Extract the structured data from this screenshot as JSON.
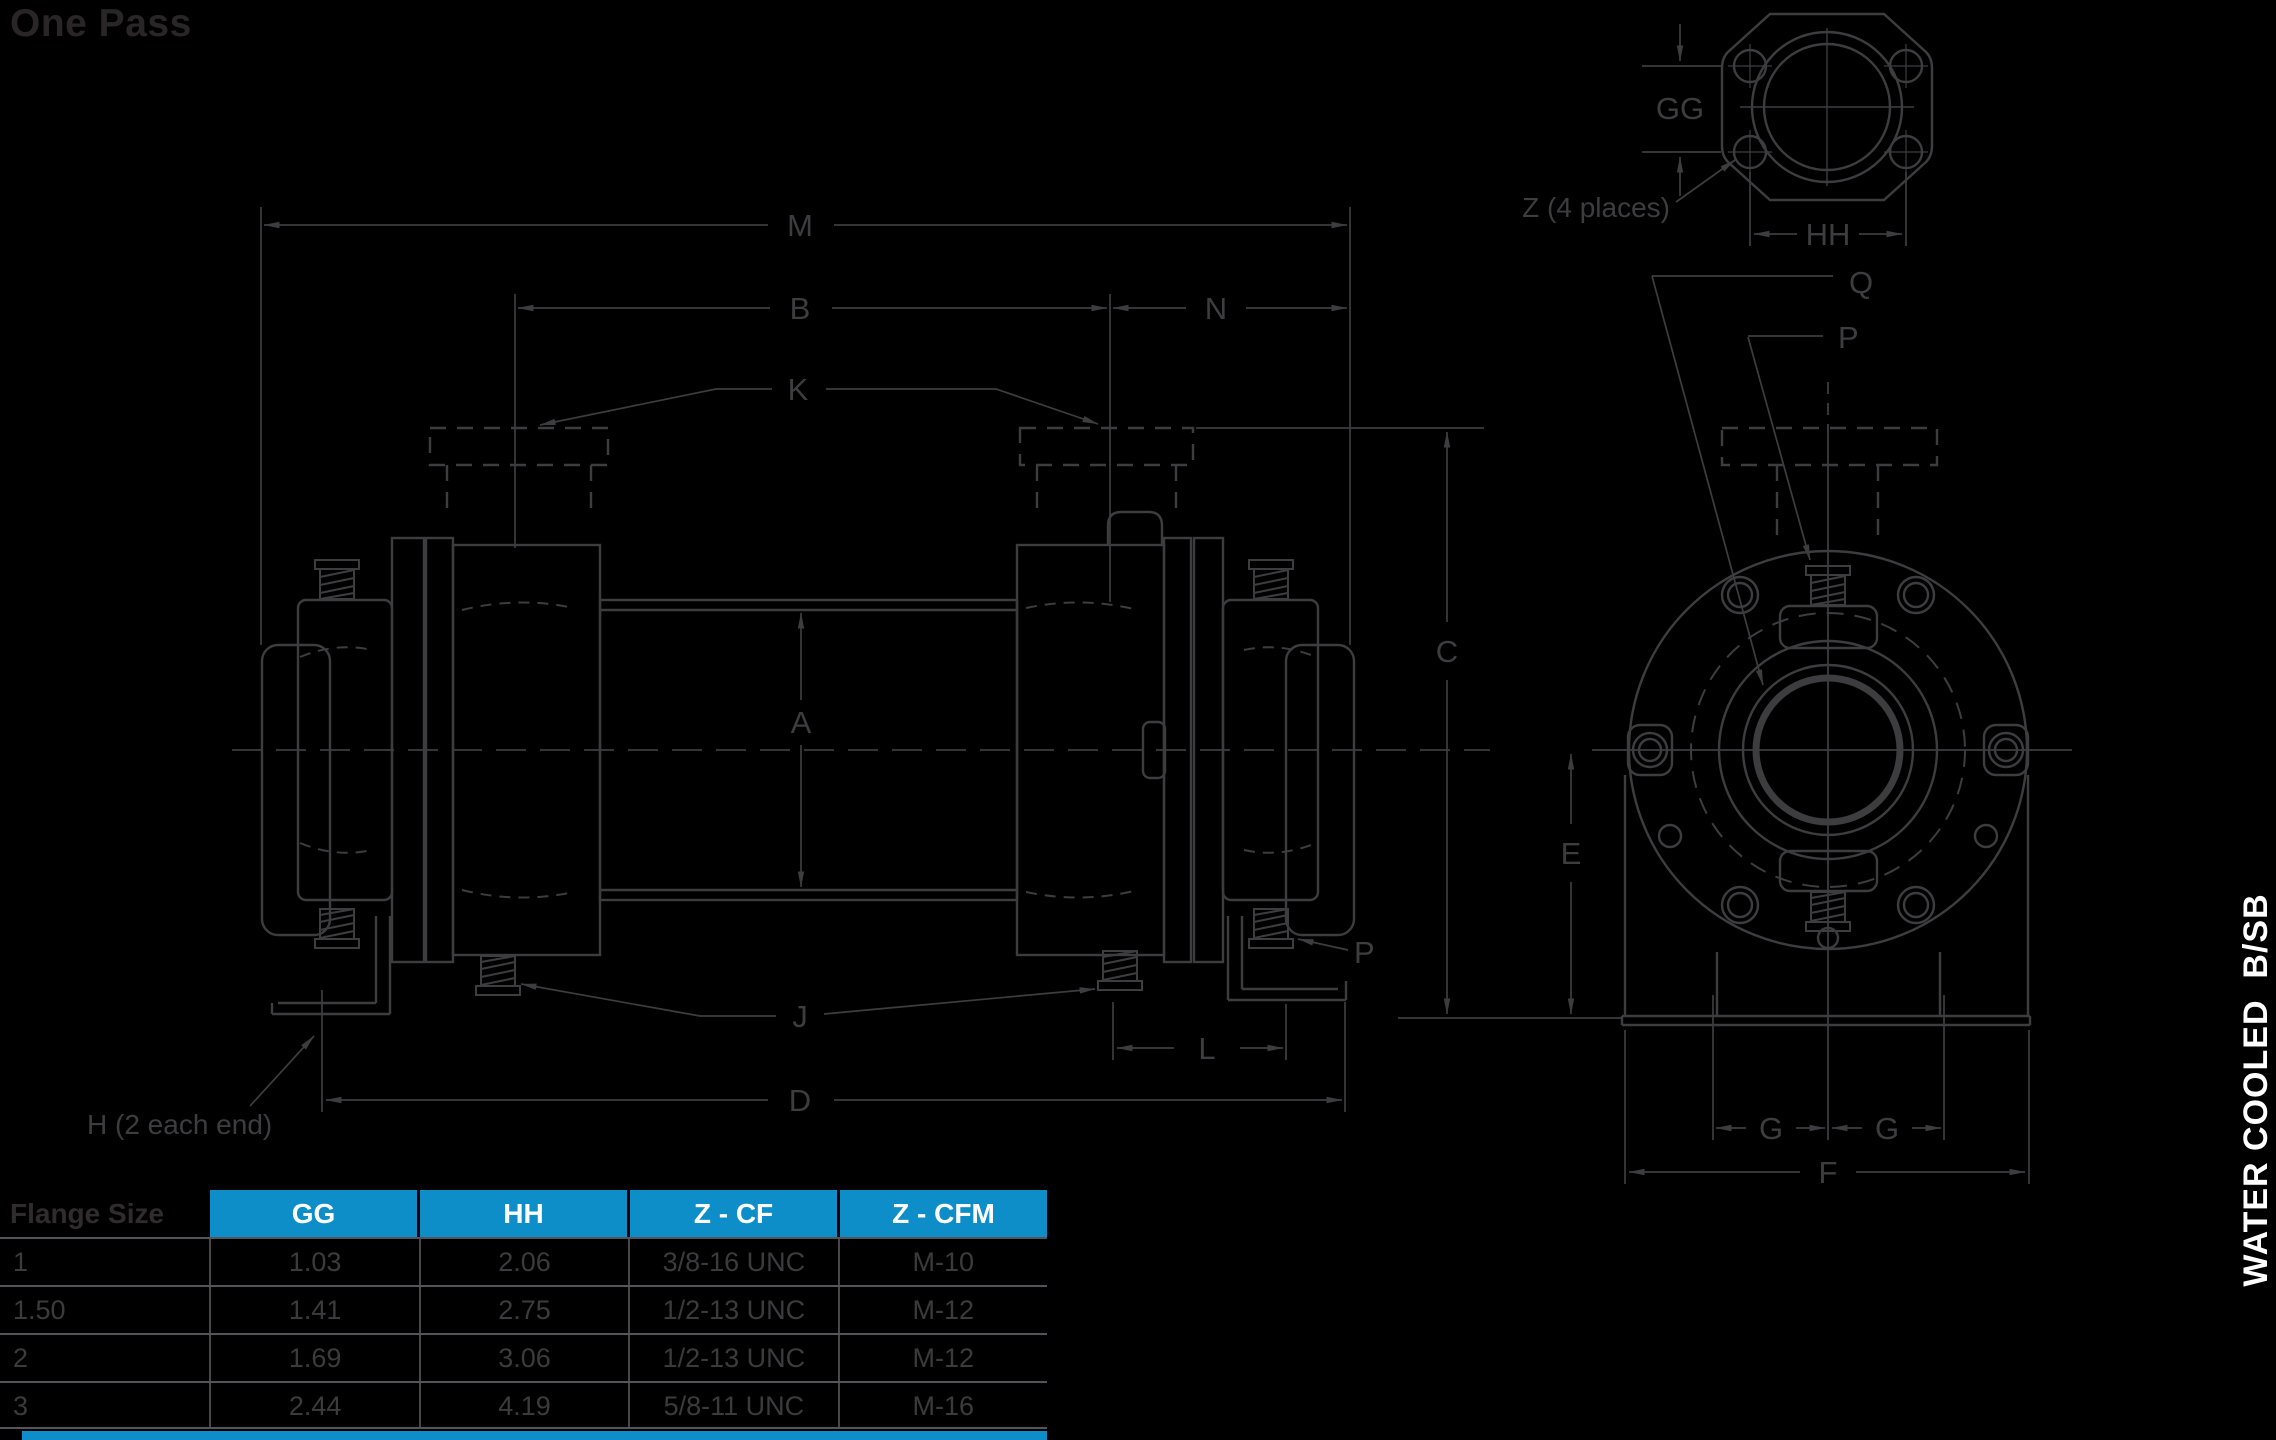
{
  "title": "One Pass",
  "side_tab_label": "WATER COOLED  B/SB",
  "drawing": {
    "labels": {
      "m": "M",
      "b": "B",
      "n": "N",
      "k": "K",
      "a": "A",
      "c": "C",
      "e": "E",
      "j": "J",
      "l": "L",
      "d": "D",
      "f": "F",
      "g1": "G",
      "g2": "G",
      "q": "Q",
      "p_end": "P",
      "p_side": "P",
      "gg": "GG",
      "hh": "HH"
    },
    "notes": {
      "z": "Z (4 places)",
      "h": "H (2 each end)"
    }
  },
  "table": {
    "row_header": "Flange Size",
    "columns": [
      "GG",
      "HH",
      "Z - CF",
      "Z - CFM"
    ],
    "rows": [
      {
        "size": "1",
        "gg": "1.03",
        "hh": "2.06",
        "z_cf": "3/8-16 UNC",
        "z_cfm": "M-10"
      },
      {
        "size": "1.50",
        "gg": "1.41",
        "hh": "2.75",
        "z_cf": "1/2-13 UNC",
        "z_cfm": "M-12"
      },
      {
        "size": "2",
        "gg": "1.69",
        "hh": "3.06",
        "z_cf": "1/2-13 UNC",
        "z_cfm": "M-12"
      },
      {
        "size": "3",
        "gg": "2.44",
        "hh": "4.19",
        "z_cf": "5/8-11 UNC",
        "z_cfm": "M-16"
      }
    ]
  },
  "colors": {
    "background": "#000000",
    "line_gray": "#3d3d40",
    "accent_blue": "#0e8ec9",
    "table_text": "#3b3b3d",
    "title_text": "#2a2627",
    "white": "#ffffff"
  }
}
